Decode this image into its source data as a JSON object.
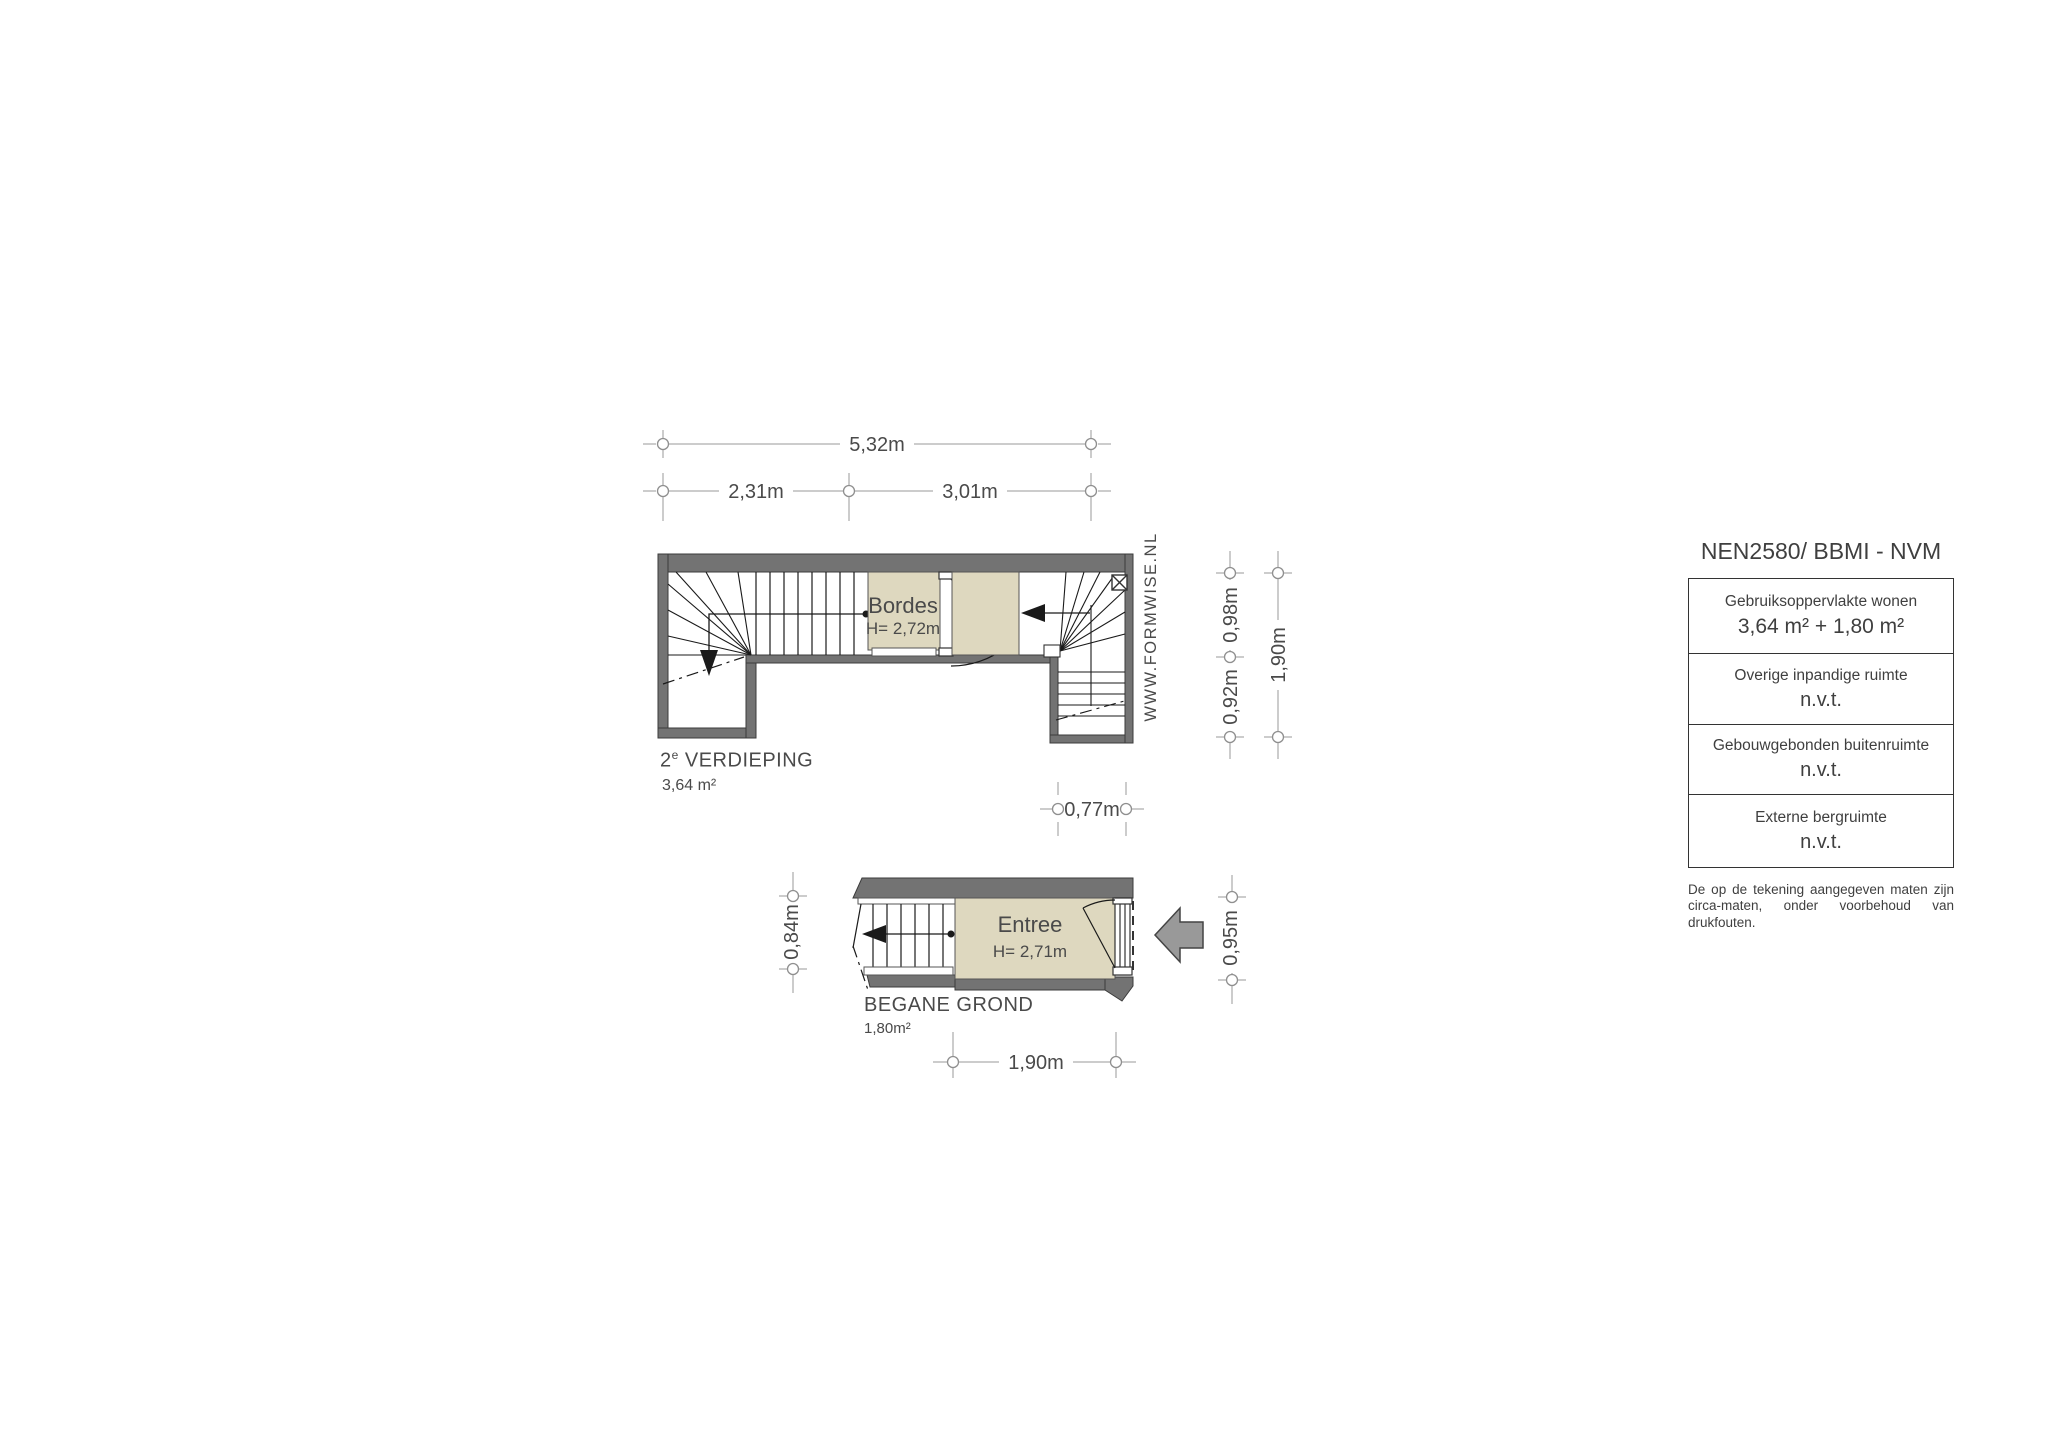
{
  "watermark": "WWW.FORMWISE.NL",
  "upper_plan": {
    "room_label": "Bordes",
    "room_height": "H= 2,72m",
    "title_prefix": "2",
    "title_sup": "e",
    "title_main": "VERDIEPING",
    "area": "3,64 m²",
    "dims": {
      "total_width": "5,32m",
      "left_width": "2,31m",
      "right_width": "3,01m",
      "right_top": "0,98m",
      "right_bottom": "0,92m",
      "right_total": "1,90m",
      "bottom": "0,77m"
    }
  },
  "lower_plan": {
    "room_label": "Entree",
    "room_height": "H= 2,71m",
    "title": "BEGANE GROND",
    "area": "1,80m²",
    "dims": {
      "left": "0,84m",
      "right": "0,95m",
      "bottom": "1,90m"
    }
  },
  "legend": {
    "title": "NEN2580/ BBMI - NVM",
    "rows": [
      {
        "label": "Gebruiksoppervlakte wonen",
        "value": "3,64 m² + 1,80 m²"
      },
      {
        "label": "Overige inpandige ruimte",
        "value": "n.v.t."
      },
      {
        "label": "Gebouwgebonden buitenruimte",
        "value": "n.v.t."
      },
      {
        "label": "Externe bergruimte",
        "value": "n.v.t."
      }
    ],
    "disclaimer": "De op de tekening aangegeven maten zijn circa-maten, onder voorbehoud van drukfouten."
  },
  "colors": {
    "wall": "#737373",
    "wall_outline": "#3b3b3b",
    "room_fill": "#ded8bf",
    "dimension_line": "#9a9a9a",
    "drawing_line": "#1a1a1a",
    "text": "#4a4a4a"
  }
}
